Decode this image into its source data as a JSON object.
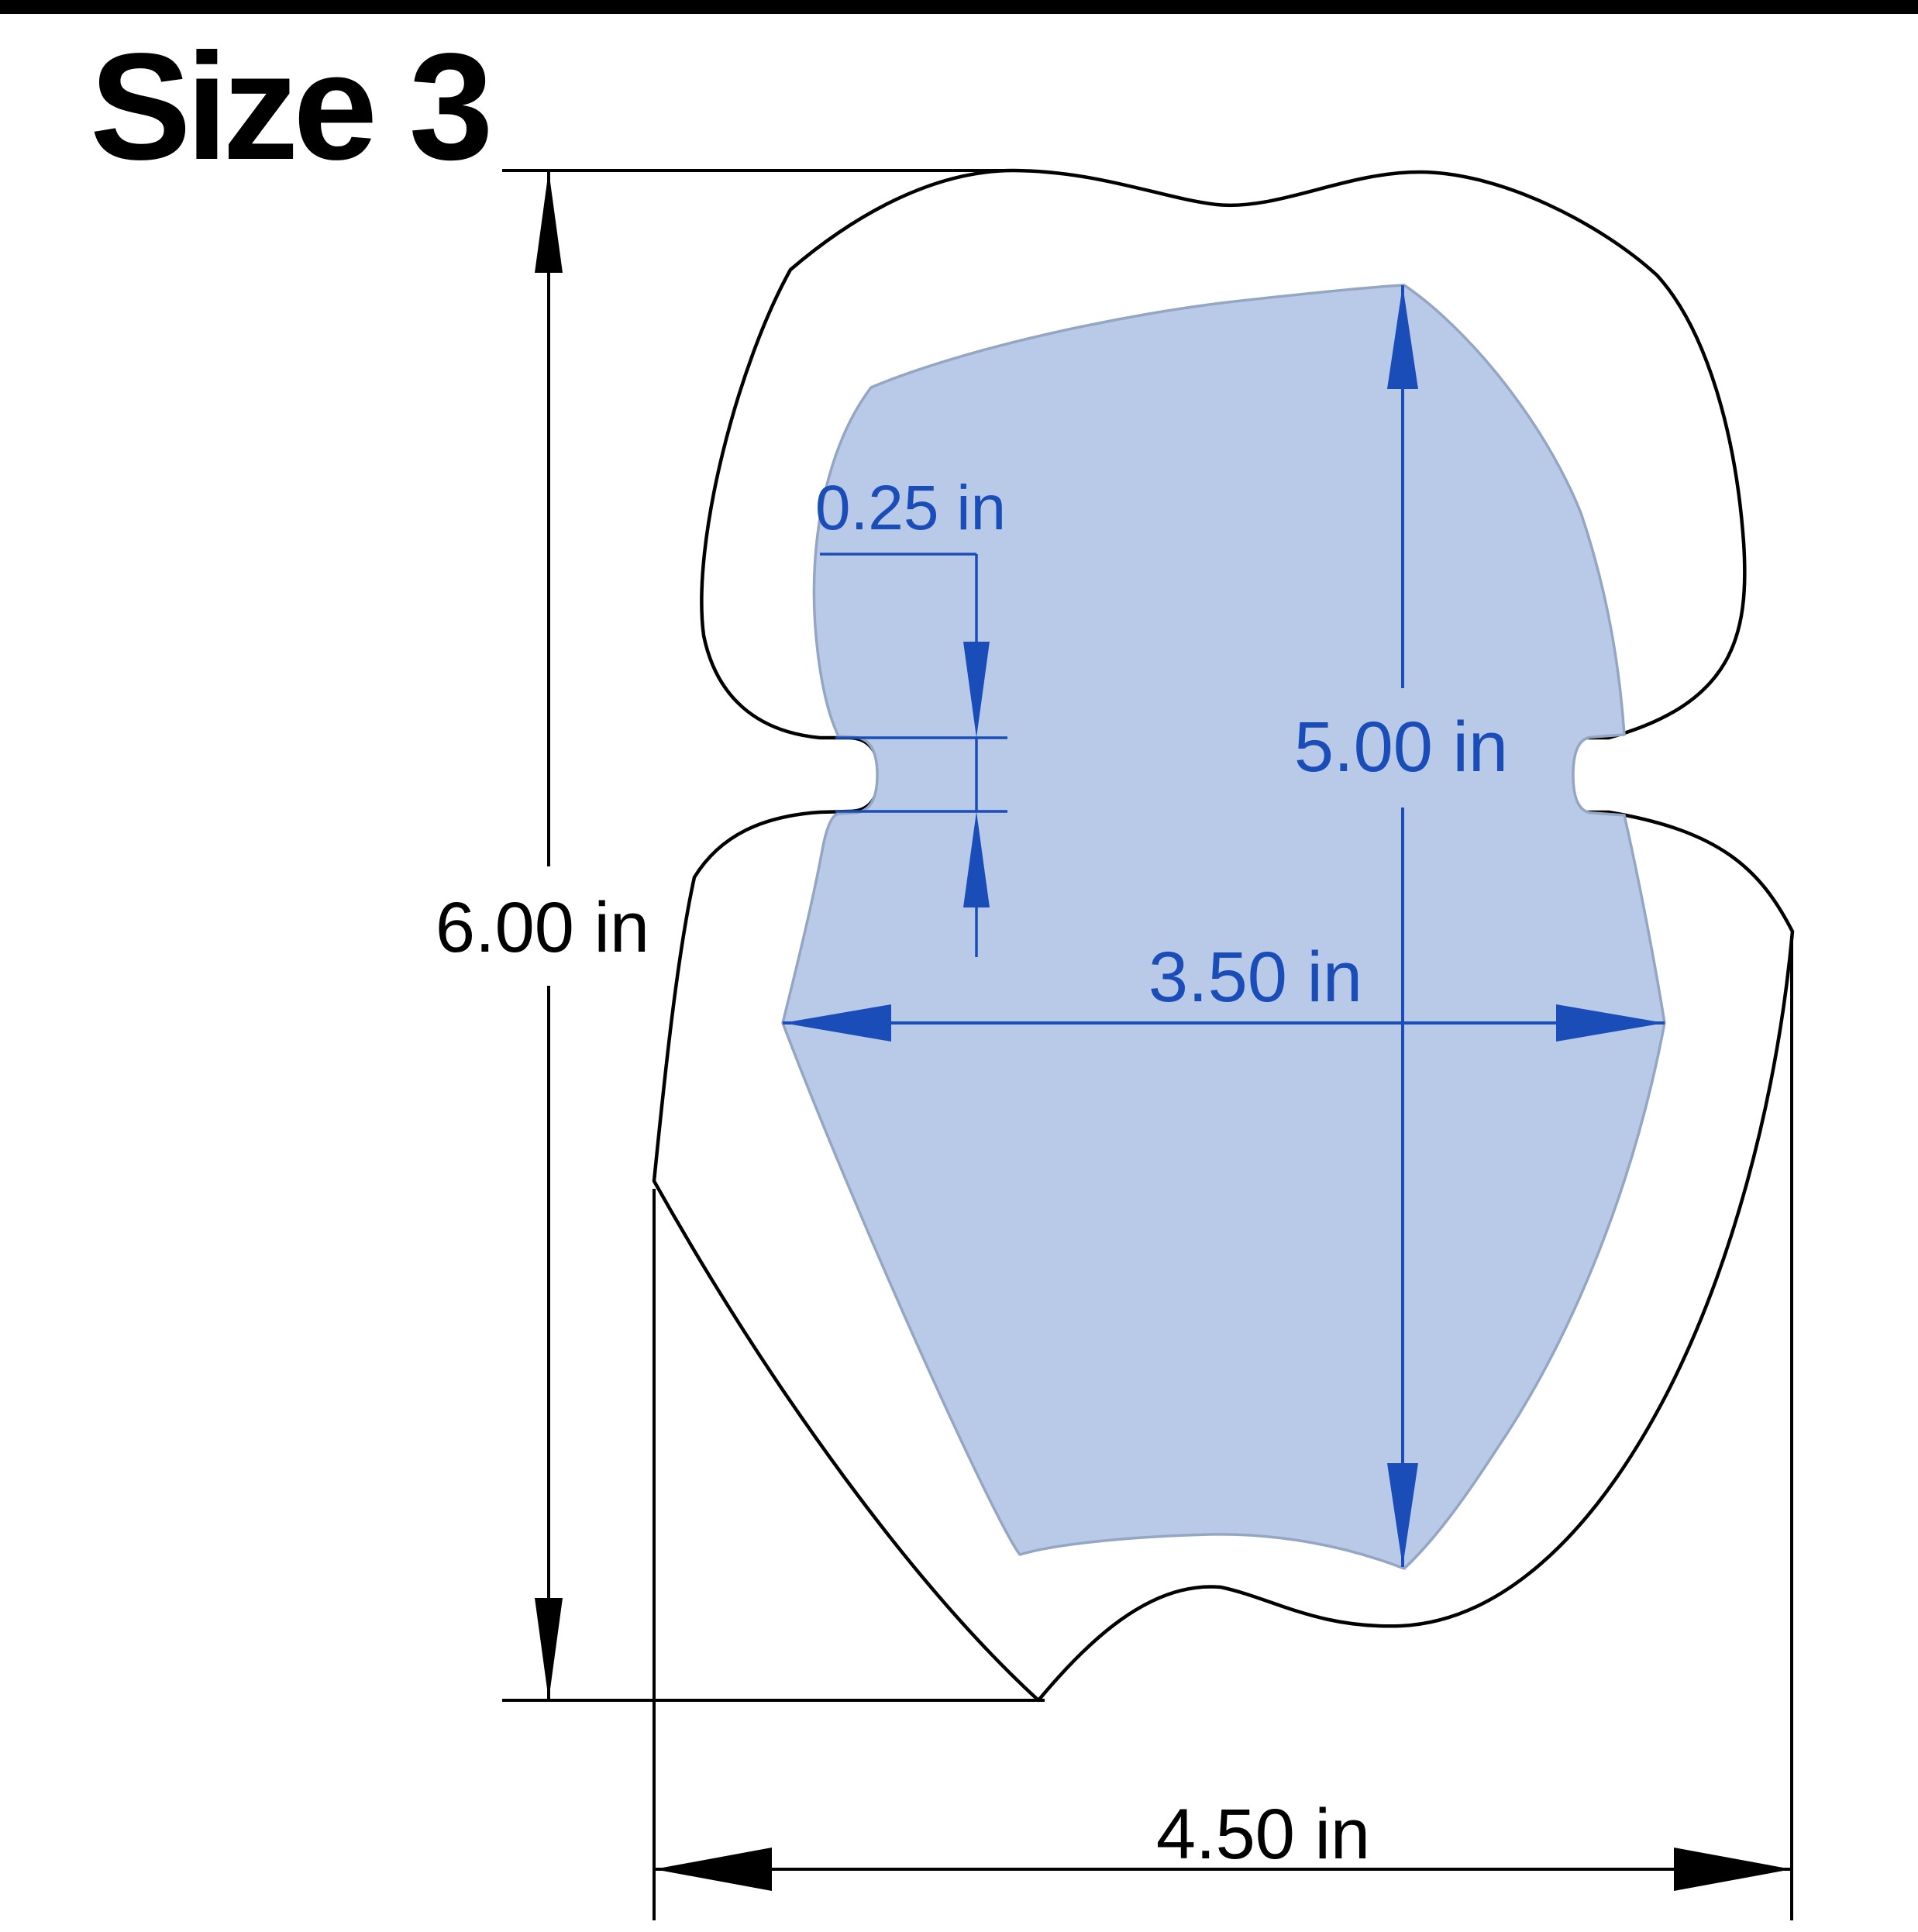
{
  "header": {
    "title": "Size 3"
  },
  "colors": {
    "dimension_blue": "#1b4db8",
    "pad_fill": "#b8cae8",
    "pad_outline": "#94a6c2",
    "outline_black": "#000000",
    "background": "#ffffff",
    "top_bar": "#000000"
  },
  "drawing": {
    "outer_shape": "outer shell silhouette",
    "inner_shape": "blue pad insert silhouette"
  },
  "dimensions": {
    "notch_depth": {
      "label": "0.25 in",
      "value": 0.25,
      "unit": "in"
    },
    "pad_height": {
      "label": "5.00 in",
      "value": 5.0,
      "unit": "in"
    },
    "pad_width": {
      "label": "3.50 in",
      "value": 3.5,
      "unit": "in"
    },
    "shell_height": {
      "label": "6.00 in",
      "value": 6.0,
      "unit": "in"
    },
    "shell_width": {
      "label": "4.50 in",
      "value": 4.5,
      "unit": "in"
    }
  }
}
